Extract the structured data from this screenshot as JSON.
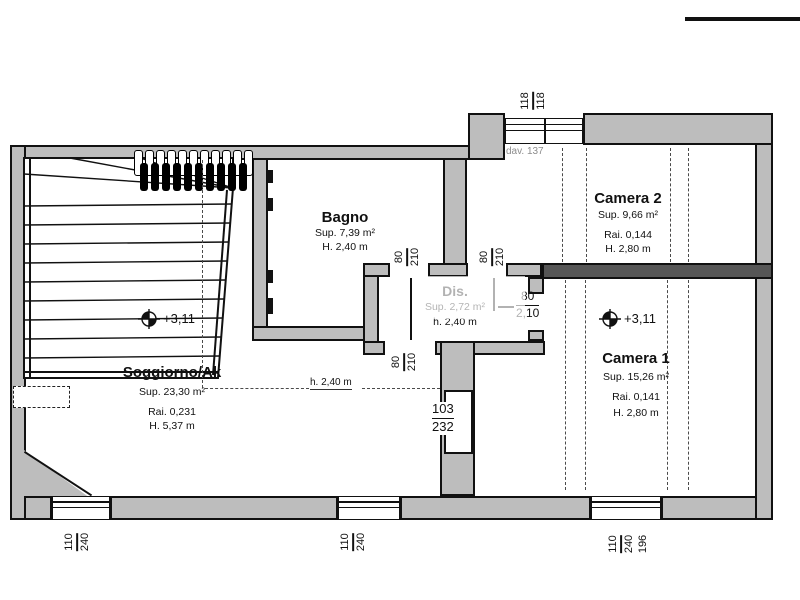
{
  "plan": {
    "rooms": {
      "soggiorno": {
        "name": "Soggiorno/Ak",
        "sup": "Sup. 23,30 m²",
        "rai": "Rai. 0,231",
        "h": "H. 5,37 m",
        "elevation": "+3,11"
      },
      "bagno": {
        "name": "Bagno",
        "sup": "Sup. 7,39 m²",
        "h": "H. 2,40 m"
      },
      "dis": {
        "name": "Dis.",
        "sup": "Sup. 2,72 m²",
        "h": "h. 2,40 m"
      },
      "camera2": {
        "name": "Camera 2",
        "sup": "Sup. 9,66 m²",
        "rai": "Rai. 0,144",
        "h": "H. 2,80 m"
      },
      "camera1": {
        "name": "Camera 1",
        "sup": "Sup. 15,26 m²",
        "rai": "Rai. 0,141",
        "h": "H. 2,80 m",
        "elevation": "+3,11"
      }
    },
    "annotations": {
      "ceiling_height_line": "h. 2,40 m",
      "sill_note": "dav. 137"
    },
    "dims": {
      "top_window": {
        "a": "118",
        "b": "118"
      },
      "door_bagno": {
        "w": "80",
        "h": "210"
      },
      "door_camera2": {
        "w": "80",
        "h": "210"
      },
      "door_soggiorno": {
        "w": "80",
        "h": "210"
      },
      "door_camera1": {
        "w": "80",
        "h": "2,10"
      },
      "wall_niche": {
        "w": "103",
        "h": "232"
      },
      "window_left": {
        "w": "110",
        "h": "240"
      },
      "window_mid": {
        "w": "110",
        "h": "240"
      },
      "window_right": {
        "w": "110",
        "h": "240",
        "extra": "196"
      }
    },
    "colors": {
      "wall": "#bdbdbd",
      "wall_dark": "#565656",
      "line": "#111111",
      "muted": "#8d8d8d"
    }
  }
}
